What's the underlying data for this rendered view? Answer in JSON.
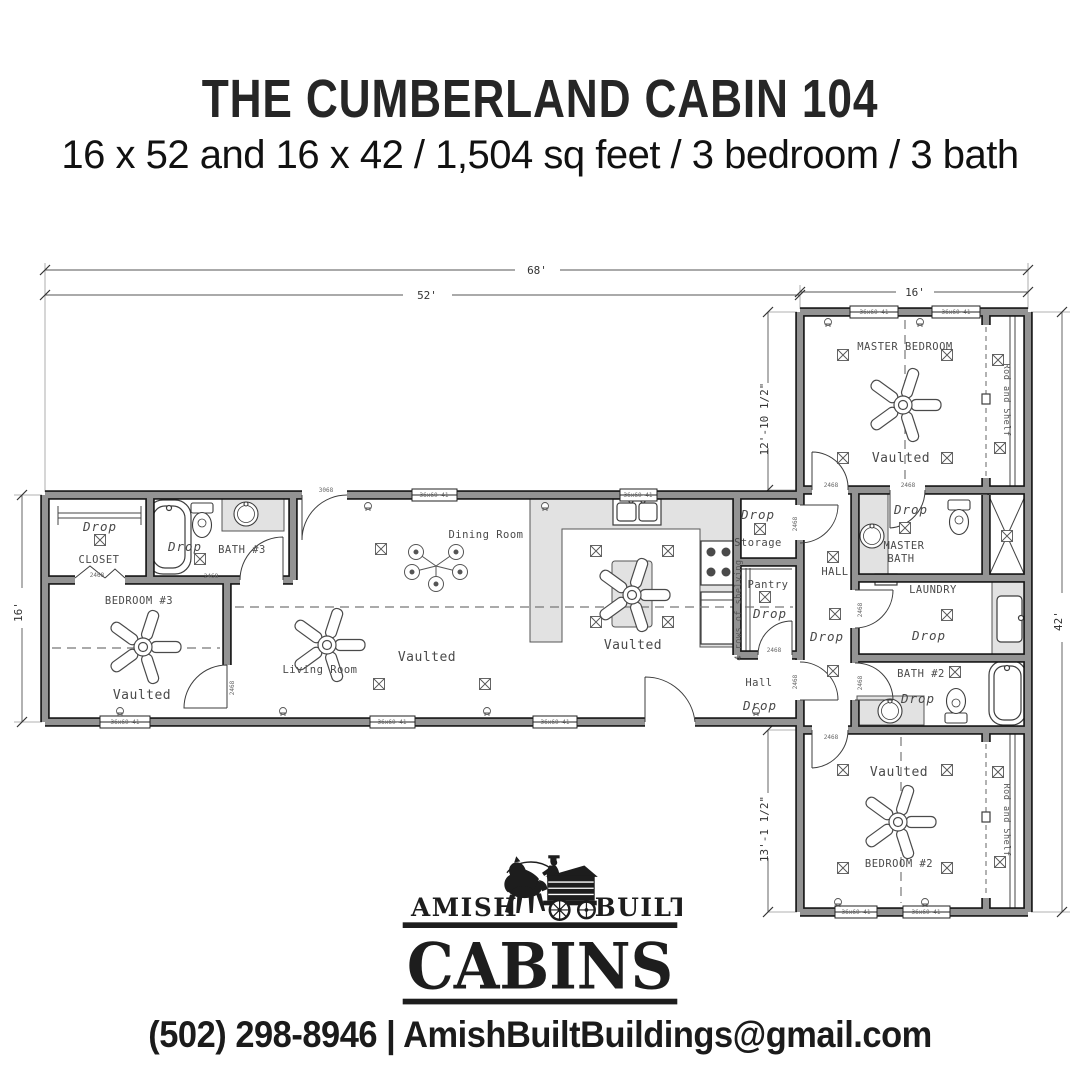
{
  "header": {
    "title": "THE CUMBERLAND CABIN 104",
    "subtitle": "16 x 52 and 16 x 42 / 1,504 sq feet / 3 bedroom / 3 bath"
  },
  "plan": {
    "dims": {
      "overall": "68'",
      "main": "52'",
      "wing": "16'",
      "depth": "16'",
      "upper": "12'-10 1/2\"",
      "lower": "13'-1 1/2\"",
      "length": "42'"
    },
    "rooms": {
      "master_bedroom": "MASTER BEDROOM",
      "bedroom2": "BEDROOM #2",
      "bedroom3": "BEDROOM #3",
      "bath2": "BATH #2",
      "bath3": "BATH #3",
      "master_bath_1": "MASTER",
      "master_bath_2": "BATH",
      "laundry": "LAUNDRY",
      "living": "Living Room",
      "dining": "Dining Room",
      "closet": "CLOSET",
      "pantry": "Pantry",
      "storage": "Storage",
      "hall_upper": "HALL",
      "hall_lower": "Hall"
    },
    "notes": {
      "drop": "Drop",
      "vaulted": "Vaulted",
      "rod_shelf": "Rod and Shelf",
      "shelving": "4 rows of shelving"
    },
    "tags": {
      "window": "36x60-41",
      "door": "2468",
      "front_door": "3068"
    }
  },
  "logo": {
    "amish": "AMISH",
    "built": "BUILT",
    "cabins": "CABINS"
  },
  "footer": {
    "phone": "(502) 298-8946",
    "divider": "|",
    "email": "AmishBuiltBuildings@gmail.com"
  }
}
